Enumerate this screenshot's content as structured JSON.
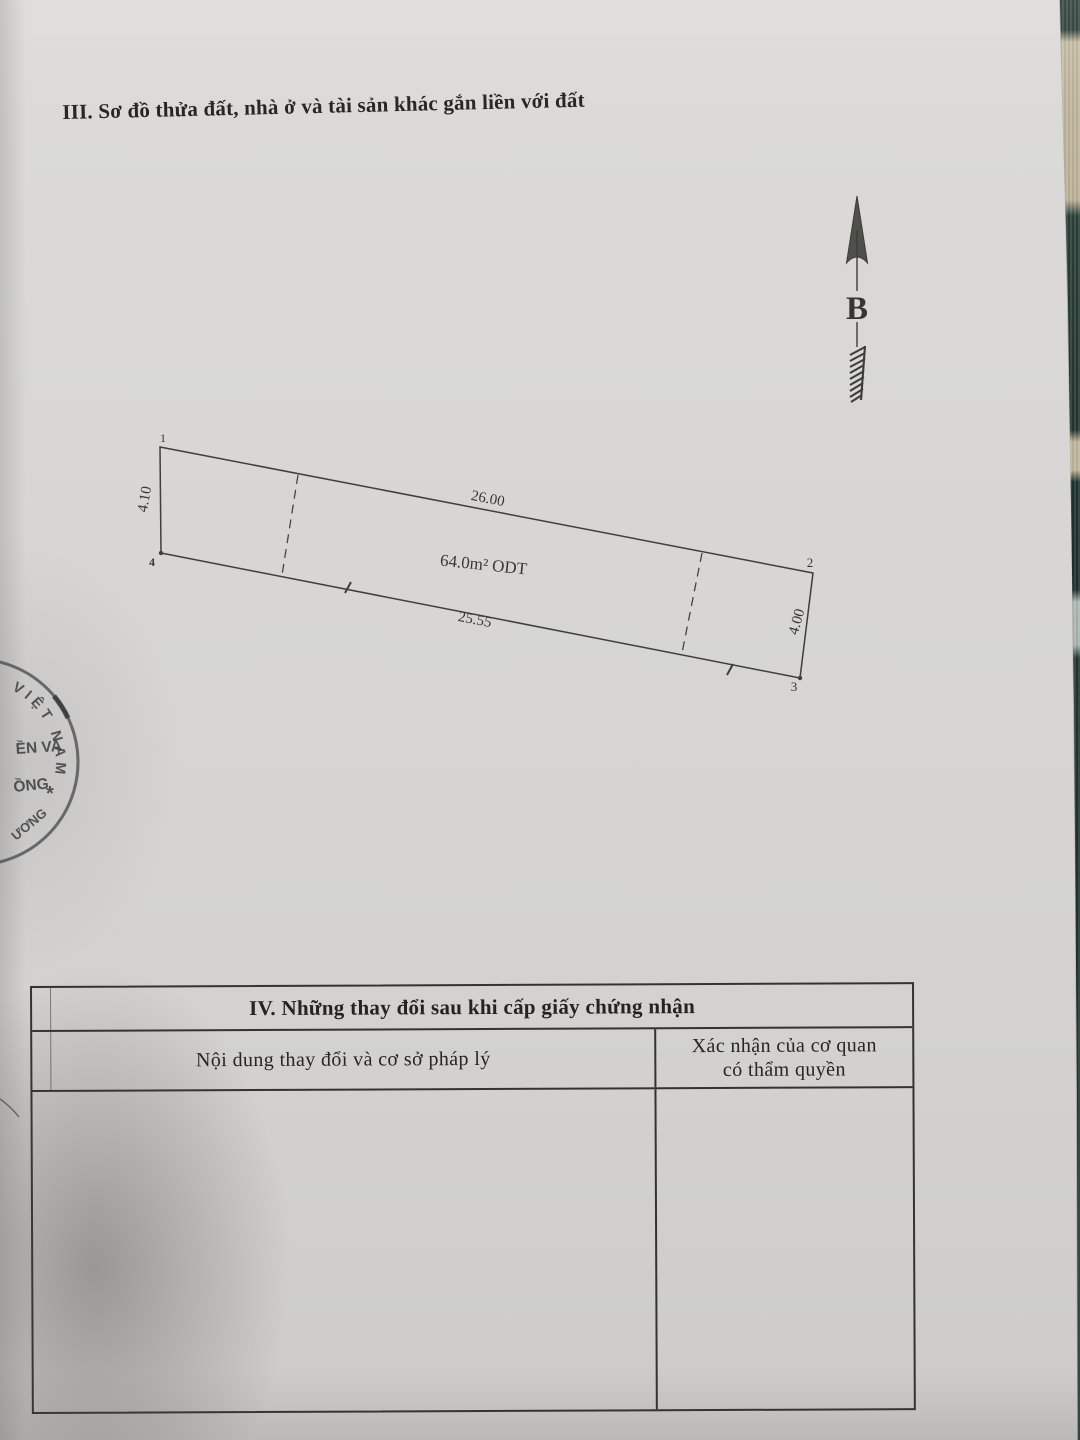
{
  "document": {
    "section_iii_title": "III. Sơ đồ thửa đất, nhà ở và tài sản khác gắn liền với đất",
    "north_arrow_label": "B"
  },
  "plot": {
    "area_label": "64.0m² ODT",
    "edge_top": "26.00",
    "edge_bottom": "25.55",
    "edge_left": "4.10",
    "edge_right": "4.00",
    "corner_1": "1",
    "corner_2": "2",
    "corner_3": "3",
    "corner_4": "4"
  },
  "seal": {
    "arc_top": "VIỆT NAM",
    "fragment_line_1": "ỀN VA",
    "fragment_line_2": "ỒNG",
    "arc_bottom": "ƯƠNG",
    "star": "*"
  },
  "section_iv_table": {
    "title": "IV. Những thay đổi sau khi cấp giấy chứng nhận",
    "col_left_header": "Nội dung thay đổi và cơ sở pháp lý",
    "col_right_header_line1": "Xác nhận của cơ quan",
    "col_right_header_line2": "có thẩm quyền",
    "body_left": "",
    "body_right": ""
  }
}
